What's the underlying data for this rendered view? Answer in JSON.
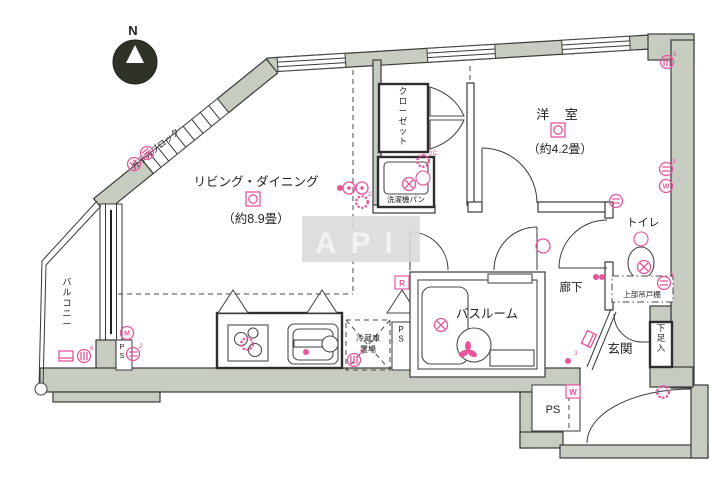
{
  "watermark": "API",
  "compass": {
    "label": "N"
  },
  "colors": {
    "wall": "#c6cdc0",
    "pink": "#e8559d",
    "line": "#3a3a3a",
    "watermark_bg": "#dadada",
    "watermark_text": "#f2f2f2",
    "compass_fill": "#2f3227"
  },
  "rooms": {
    "living": {
      "name": "リビング・ダイニング",
      "size": "（約8.9畳）"
    },
    "western": {
      "name": "洋 室",
      "size": "（約4.2畳）"
    },
    "bathroom": {
      "name": "バスルーム"
    },
    "hallway": {
      "name": "廊下"
    },
    "toilet": {
      "name": "トイレ"
    },
    "entrance": {
      "name": "玄関"
    },
    "balcony": {
      "name": "バルコニー"
    },
    "closet": {
      "name": "クローゼット"
    },
    "laundry": {
      "name": "洗濯機パン"
    },
    "fridge": {
      "line1": "冷蔵庫",
      "line2": "置場"
    },
    "shoebox": {
      "name": "下足入"
    },
    "cabinet": {
      "name": "上部吊戸棚"
    },
    "glassblock": {
      "name": "ガラスブロック"
    },
    "ps": "PS"
  },
  "texts": [
    {
      "id": "label-living-name",
      "text": "リビング・ダイニング",
      "x": 256,
      "y": 186,
      "size": 12.5
    },
    {
      "id": "label-living-size",
      "text": "（約8.9畳）",
      "x": 256,
      "y": 223,
      "size": 12.5
    },
    {
      "id": "label-western-name",
      "text": "洋 室",
      "x": 560,
      "y": 119,
      "size": 13,
      "spacing": 6
    },
    {
      "id": "label-western-size",
      "text": "（約4.2畳）",
      "x": 560,
      "y": 153,
      "size": 12
    },
    {
      "id": "label-bathroom",
      "text": "バスルーム",
      "x": 487,
      "y": 318,
      "size": 12.5
    },
    {
      "id": "label-hallway",
      "text": "廊下",
      "x": 571,
      "y": 291,
      "size": 11.5
    },
    {
      "id": "label-toilet",
      "text": "トイレ",
      "x": 643,
      "y": 226,
      "size": 11
    },
    {
      "id": "label-cabinet",
      "text": "上部吊戸棚",
      "x": 642,
      "y": 297,
      "size": 7.5
    },
    {
      "id": "label-entrance",
      "text": "玄関",
      "x": 620,
      "y": 353,
      "size": 12.5
    },
    {
      "id": "label-laundry",
      "text": "洗濯機パン",
      "x": 406,
      "y": 202,
      "size": 7.5
    },
    {
      "id": "label-fridge-1",
      "text": "冷蔵庫",
      "x": 368,
      "y": 341,
      "size": 8
    },
    {
      "id": "label-fridge-2",
      "text": "置場",
      "x": 368,
      "y": 352,
      "size": 8
    },
    {
      "id": "label-ps-a",
      "text": "PS",
      "x": 401,
      "y": 332,
      "size": 8,
      "vertical": true
    },
    {
      "id": "label-ps-b",
      "text": "PS",
      "x": 122,
      "y": 349,
      "size": 7.5,
      "vertical": true
    },
    {
      "id": "label-ps-c",
      "text": "PS",
      "x": 553,
      "y": 413,
      "size": 11
    },
    {
      "id": "label-shoebox",
      "text": "下足入",
      "x": 661,
      "y": 331,
      "size": 8.5,
      "vertical": true
    },
    {
      "id": "label-closet",
      "text": "クローゼット",
      "x": 403,
      "y": 94,
      "size": 8.5,
      "vertical": true
    },
    {
      "id": "label-balcony",
      "text": "バルコニー",
      "x": 67,
      "y": 285,
      "size": 9,
      "vertical": true
    },
    {
      "id": "label-glassblock",
      "text": "ガラスブロック",
      "x": 134,
      "y": 170,
      "size": 8.5,
      "rot": -39,
      "anchor": "start"
    },
    {
      "id": "label-compass-n",
      "text": "N",
      "x": 133,
      "y": 35,
      "size": 13,
      "weight": "bold"
    },
    {
      "id": "label-watermark",
      "text": "API",
      "x": 361,
      "y": 253,
      "size": 30,
      "weight": "bold",
      "spacing": 14,
      "color": "#f2f2f2"
    }
  ],
  "symbols": [
    {
      "type": "ceiling-light",
      "name": "ceiling-light-living",
      "x": 253,
      "y": 199
    },
    {
      "type": "ceiling-light",
      "name": "ceiling-light-western",
      "x": 558,
      "y": 130
    },
    {
      "type": "circle-lines",
      "name": "outlet",
      "x": 134,
      "y": 164,
      "rot": 50
    },
    {
      "type": "circle-vlines",
      "name": "outlet",
      "x": 147,
      "y": 153,
      "rot": 50
    },
    {
      "type": "circle-letter",
      "name": "outlet-m",
      "x": 127,
      "y": 333,
      "ch": "M"
    },
    {
      "type": "circle-lines",
      "name": "outlet",
      "x": 133,
      "y": 354,
      "label": "2"
    },
    {
      "type": "rect-symbol",
      "name": "tv-terminal",
      "x": 66,
      "y": 356
    },
    {
      "type": "circle-vlines",
      "name": "outlet",
      "x": 84,
      "y": 356,
      "label": "6"
    },
    {
      "type": "scallop",
      "name": "gas-outlet",
      "x": 247,
      "y": 344
    },
    {
      "type": "dot",
      "name": "faucet-point",
      "x": 306,
      "y": 352
    },
    {
      "type": "circle-vlines",
      "name": "outlet",
      "x": 354,
      "y": 360,
      "label": "E"
    },
    {
      "type": "circle-dot",
      "name": "switch",
      "x": 349,
      "y": 188
    },
    {
      "type": "circle-dot",
      "name": "switch",
      "x": 362,
      "y": 188
    },
    {
      "type": "dot",
      "name": "point",
      "x": 340,
      "y": 188
    },
    {
      "type": "scallop",
      "name": "outlet",
      "x": 362,
      "y": 202,
      "label": "2"
    },
    {
      "type": "circle-cross",
      "name": "vent-fan",
      "x": 409,
      "y": 184
    },
    {
      "type": "white-circle",
      "name": "downlight",
      "x": 423,
      "y": 178
    },
    {
      "type": "scallop",
      "name": "outlet",
      "x": 423,
      "y": 161,
      "label": "2C"
    },
    {
      "type": "circle-cross",
      "name": "vent-fan",
      "x": 441,
      "y": 325
    },
    {
      "type": "fan",
      "name": "exhaust-fan",
      "x": 468,
      "y": 351
    },
    {
      "type": "plain-circle",
      "name": "downlight",
      "x": 543,
      "y": 246
    },
    {
      "type": "dot",
      "name": "point",
      "x": 596,
      "y": 277
    },
    {
      "type": "dot",
      "name": "point",
      "x": 602,
      "y": 277
    },
    {
      "type": "white-circle",
      "name": "downlight",
      "x": 641,
      "y": 239
    },
    {
      "type": "circle-cross",
      "name": "vent-fan",
      "x": 644,
      "y": 267
    },
    {
      "type": "circle-lines",
      "name": "outlet",
      "x": 664,
      "y": 283,
      "label": "3"
    },
    {
      "type": "circle-lines",
      "name": "outlet",
      "x": 616,
      "y": 201
    },
    {
      "type": "circle-vlines",
      "name": "sprinkler",
      "x": 667,
      "y": 62,
      "label": "6"
    },
    {
      "type": "circle-lines",
      "name": "outlet",
      "x": 666,
      "y": 169,
      "label": "3"
    },
    {
      "type": "circle-letter",
      "name": "outlet-w",
      "x": 666,
      "y": 186,
      "ch": "W"
    },
    {
      "type": "rect-symbol",
      "name": "intercom",
      "x": 589,
      "y": 339,
      "rot": -65
    },
    {
      "type": "dot",
      "name": "point",
      "x": 568,
      "y": 361,
      "label": "3"
    },
    {
      "type": "scallop",
      "name": "outlet",
      "x": 663,
      "y": 392
    },
    {
      "type": "boxed-letter",
      "name": "range-label",
      "x": 402,
      "y": 283,
      "ch": "R"
    },
    {
      "type": "boxed-letter",
      "name": "washer-label",
      "x": 573,
      "y": 392,
      "ch": "W"
    }
  ]
}
